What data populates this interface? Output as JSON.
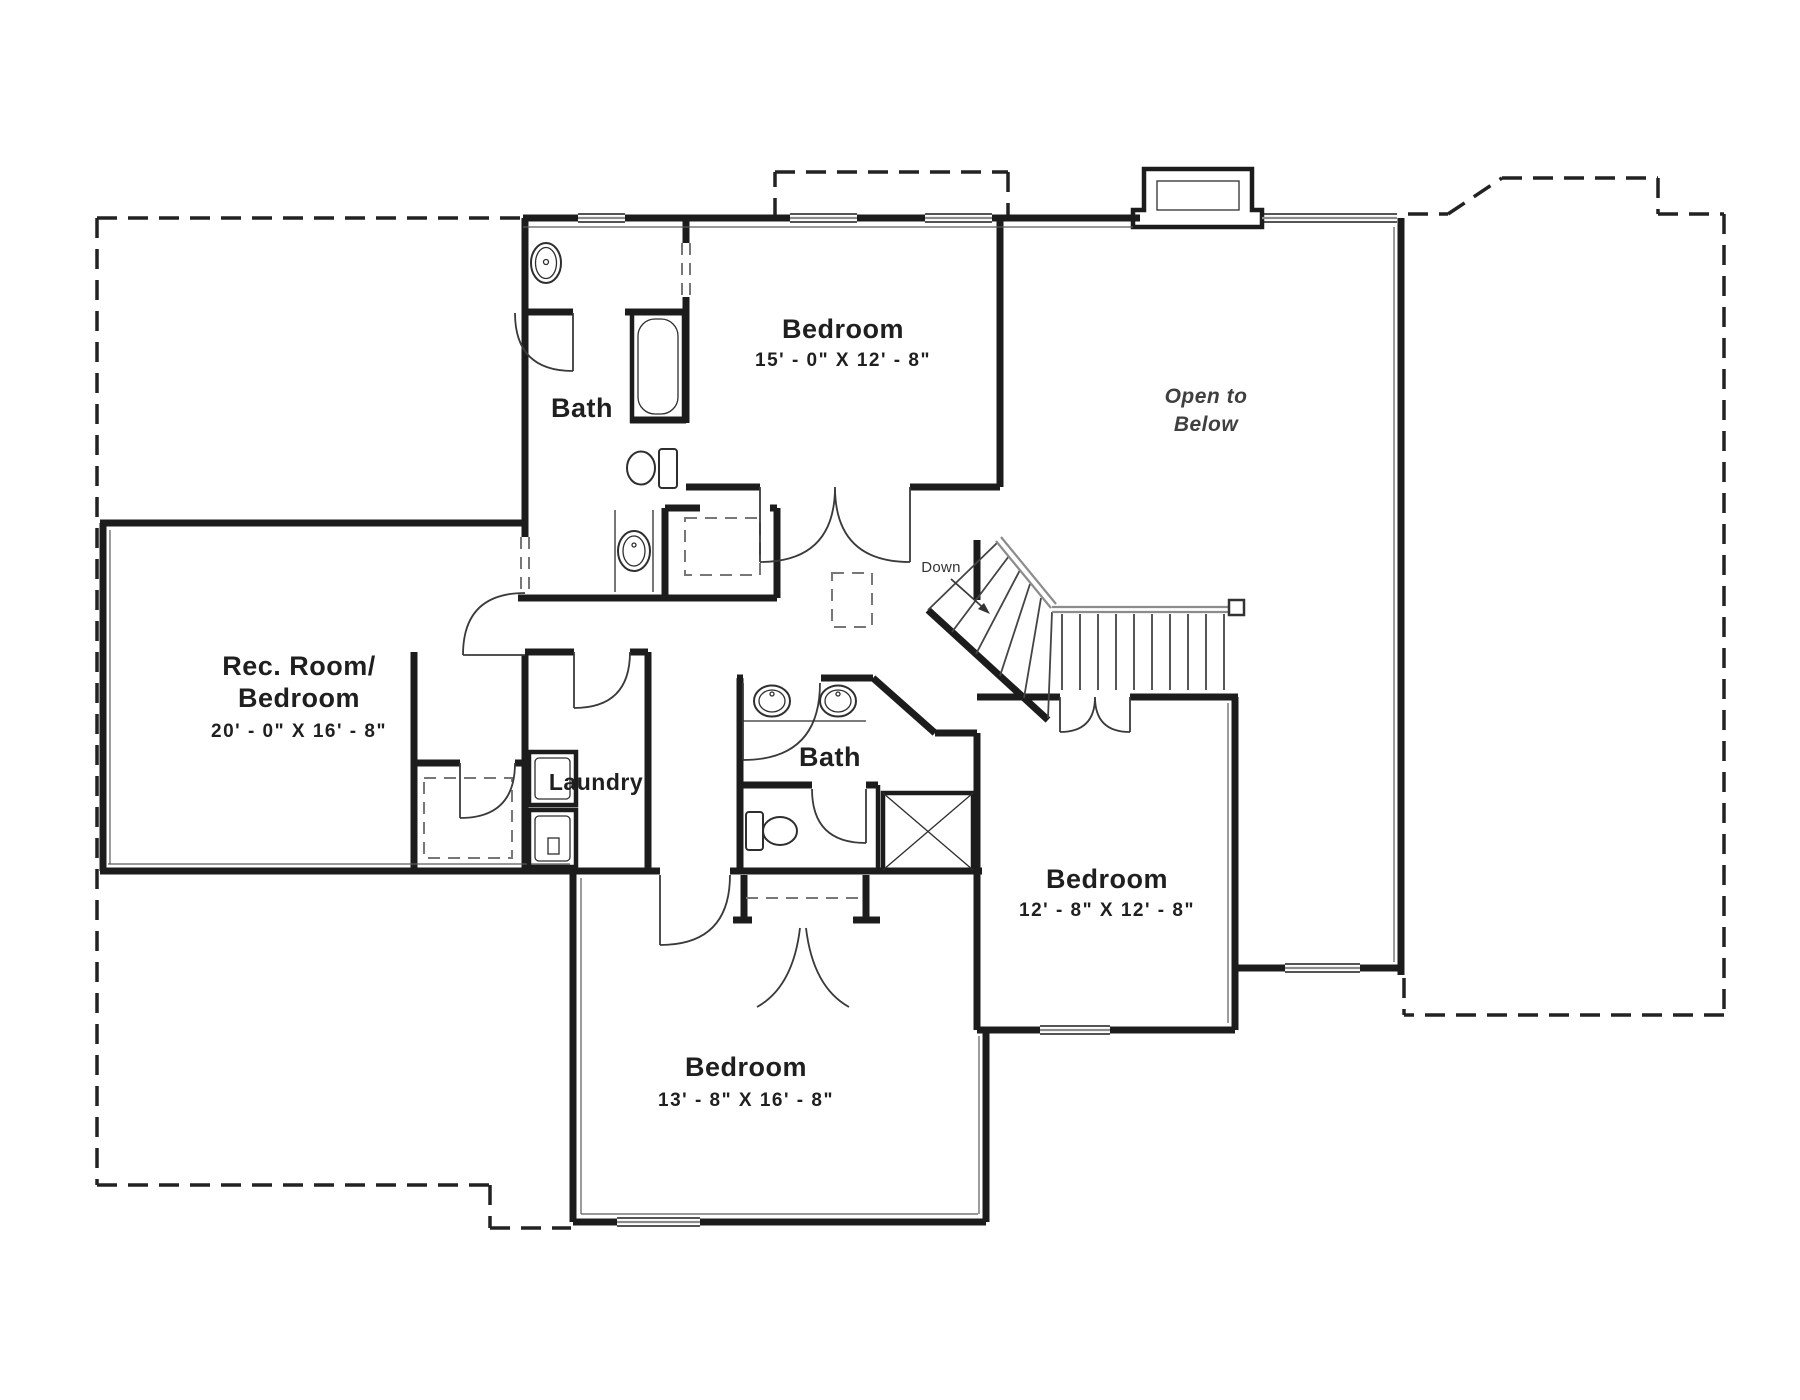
{
  "plan": {
    "rooms": {
      "bedroom_top": {
        "label": "Bedroom",
        "dims": "15' - 0\" X 12' - 8\""
      },
      "bath_top": {
        "label": "Bath"
      },
      "rec_room": {
        "label_line1": "Rec. Room/",
        "label_line2": "Bedroom",
        "dims": "20' - 0\" X 16' - 8\""
      },
      "laundry": {
        "label": "Laundry"
      },
      "bath_center": {
        "label": "Bath"
      },
      "bedroom_right": {
        "label": "Bedroom",
        "dims": "12' - 8\" X 12' - 8\""
      },
      "bedroom_bottom": {
        "label": "Bedroom",
        "dims": "13' - 8\" X 16' - 8\""
      }
    },
    "annotations": {
      "open_to_below_line1": "Open to",
      "open_to_below_line2": "Below",
      "stairs_down": "Down"
    },
    "colors": {
      "wall": "#1c1c1c",
      "thin_line": "#3a3a3a",
      "dashed_line": "#222222",
      "railing": "#8c8c8c",
      "label_text": "#1f1f1f",
      "annotation_text": "#3f3f3f",
      "background": "#ffffff"
    },
    "icons": [
      "pedestal-sink-icon",
      "bathtub-icon",
      "toilet-icon",
      "vanity-sink-icon",
      "double-vanity-sink-icon",
      "shower-icon",
      "washer-icon",
      "dryer-icon",
      "attic-access",
      "chimney",
      "stair-railing",
      "stairs-down-arrow"
    ]
  }
}
